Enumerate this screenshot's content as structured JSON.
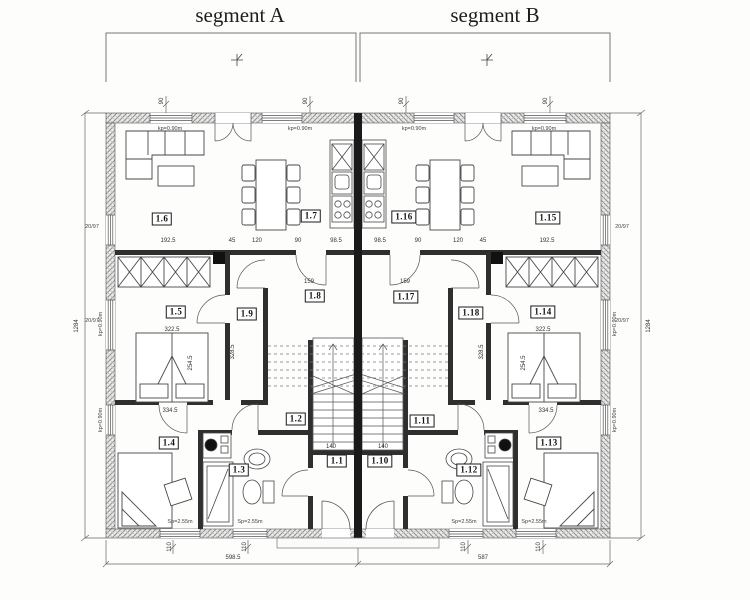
{
  "titles": {
    "segment_a": "segment A",
    "segment_b": "segment B"
  },
  "room_labels": [
    {
      "id": "1-6",
      "label": "1.6",
      "x": 162,
      "y": 219
    },
    {
      "id": "1-7",
      "label": "1.7",
      "x": 311,
      "y": 216
    },
    {
      "id": "1-16",
      "label": "1.16",
      "x": 404,
      "y": 217
    },
    {
      "id": "1-15",
      "label": "1.15",
      "x": 548,
      "y": 218
    },
    {
      "id": "1-5",
      "label": "1.5",
      "x": 176,
      "y": 312
    },
    {
      "id": "1-9",
      "label": "1.9",
      "x": 247,
      "y": 314
    },
    {
      "id": "1-8",
      "label": "1.8",
      "x": 315,
      "y": 296
    },
    {
      "id": "1-17",
      "label": "1.17",
      "x": 406,
      "y": 297
    },
    {
      "id": "1-18",
      "label": "1.18",
      "x": 471,
      "y": 313
    },
    {
      "id": "1-14",
      "label": "1.14",
      "x": 543,
      "y": 312
    },
    {
      "id": "1-4",
      "label": "1.4",
      "x": 169,
      "y": 443
    },
    {
      "id": "1-3",
      "label": "1.3",
      "x": 239,
      "y": 470
    },
    {
      "id": "1-2",
      "label": "1.2",
      "x": 296,
      "y": 419
    },
    {
      "id": "1-1",
      "label": "1.1",
      "x": 337,
      "y": 461
    },
    {
      "id": "1-10",
      "label": "1.10",
      "x": 380,
      "y": 461
    },
    {
      "id": "1-11",
      "label": "1.11",
      "x": 422,
      "y": 421
    },
    {
      "id": "1-12",
      "label": "1.12",
      "x": 469,
      "y": 470
    },
    {
      "id": "1-13",
      "label": "1.13",
      "x": 549,
      "y": 443
    }
  ],
  "dim_labels": [
    {
      "t": "598.5",
      "x": 233,
      "y": 558,
      "r": 0
    },
    {
      "t": "587",
      "x": 483,
      "y": 558,
      "r": 0
    },
    {
      "t": "1284",
      "x": 77,
      "y": 326,
      "r": -90
    },
    {
      "t": "1284",
      "x": 649,
      "y": 326,
      "r": -90
    },
    {
      "t": "192.5",
      "x": 168,
      "y": 241,
      "r": 0
    },
    {
      "t": "45",
      "x": 232,
      "y": 241,
      "r": 0
    },
    {
      "t": "120",
      "x": 257,
      "y": 241,
      "r": 0
    },
    {
      "t": "90",
      "x": 298,
      "y": 241,
      "r": 0
    },
    {
      "t": "98.5",
      "x": 336,
      "y": 241,
      "r": 0
    },
    {
      "t": "98.5",
      "x": 380,
      "y": 241,
      "r": 0
    },
    {
      "t": "90",
      "x": 418,
      "y": 241,
      "r": 0
    },
    {
      "t": "120",
      "x": 458,
      "y": 241,
      "r": 0
    },
    {
      "t": "45",
      "x": 483,
      "y": 241,
      "r": 0
    },
    {
      "t": "192.5",
      "x": 547,
      "y": 241,
      "r": 0
    },
    {
      "t": "322.5",
      "x": 172,
      "y": 330,
      "r": 0
    },
    {
      "t": "322.5",
      "x": 543,
      "y": 330,
      "r": 0
    },
    {
      "t": "334.5",
      "x": 170,
      "y": 411,
      "r": 0
    },
    {
      "t": "334.5",
      "x": 546,
      "y": 411,
      "r": 0
    },
    {
      "t": "254.5",
      "x": 191,
      "y": 363,
      "r": -90
    },
    {
      "t": "254.5",
      "x": 524,
      "y": 363,
      "r": -90
    },
    {
      "t": "328.5",
      "x": 233,
      "y": 352,
      "r": -90
    },
    {
      "t": "328.5",
      "x": 482,
      "y": 352,
      "r": -90
    },
    {
      "t": "159",
      "x": 309,
      "y": 282,
      "r": 0
    },
    {
      "t": "159",
      "x": 405,
      "y": 282,
      "r": 0
    },
    {
      "t": "140",
      "x": 331,
      "y": 447,
      "r": 0
    },
    {
      "t": "140",
      "x": 383,
      "y": 447,
      "r": 0
    },
    {
      "t": "110",
      "x": 170,
      "y": 547,
      "r": -90
    },
    {
      "t": "110",
      "x": 245,
      "y": 547,
      "r": -90
    },
    {
      "t": "110",
      "x": 464,
      "y": 547,
      "r": -90
    },
    {
      "t": "110",
      "x": 539,
      "y": 547,
      "r": -90
    },
    {
      "t": "90",
      "x": 162,
      "y": 101,
      "r": -90
    },
    {
      "t": "90",
      "x": 306,
      "y": 101,
      "r": -90
    },
    {
      "t": "90",
      "x": 402,
      "y": 101,
      "r": -90
    },
    {
      "t": "90",
      "x": 546,
      "y": 101,
      "r": -90
    }
  ],
  "annotations": [
    {
      "t": "kp=0.90m",
      "x": 170,
      "y": 129,
      "r": 0
    },
    {
      "t": "kp=0.90m",
      "x": 300,
      "y": 129,
      "r": 0
    },
    {
      "t": "kp=0.90m",
      "x": 414,
      "y": 129,
      "r": 0
    },
    {
      "t": "kp=0.90m",
      "x": 544,
      "y": 129,
      "r": 0
    },
    {
      "t": "kp=0.90m",
      "x": 101,
      "y": 324,
      "r": -90
    },
    {
      "t": "kp=0.90m",
      "x": 615,
      "y": 324,
      "r": -90
    },
    {
      "t": "kp=0.90m",
      "x": 101,
      "y": 420,
      "r": -90
    },
    {
      "t": "kp=0.90m",
      "x": 615,
      "y": 420,
      "r": -90
    },
    {
      "t": "Sp=2.55m",
      "x": 180,
      "y": 522,
      "r": 0
    },
    {
      "t": "Sp=2.55m",
      "x": 250,
      "y": 522,
      "r": 0
    },
    {
      "t": "Sp=2.55m",
      "x": 464,
      "y": 522,
      "r": 0
    },
    {
      "t": "Sp=2.55m",
      "x": 534,
      "y": 522,
      "r": 0
    },
    {
      "t": "20/97",
      "x": 92,
      "y": 227,
      "r": 0
    },
    {
      "t": "20/97",
      "x": 92,
      "y": 321,
      "r": 0
    },
    {
      "t": "20/97",
      "x": 622,
      "y": 227,
      "r": 0
    },
    {
      "t": "20/97",
      "x": 622,
      "y": 321,
      "r": 0
    }
  ],
  "colors": {
    "party_wall": "#1a1a1a",
    "interior_wall": "#2f2f2f",
    "exterior_hatch": "#909090",
    "line": "#555555",
    "dim_text": "#333333"
  }
}
